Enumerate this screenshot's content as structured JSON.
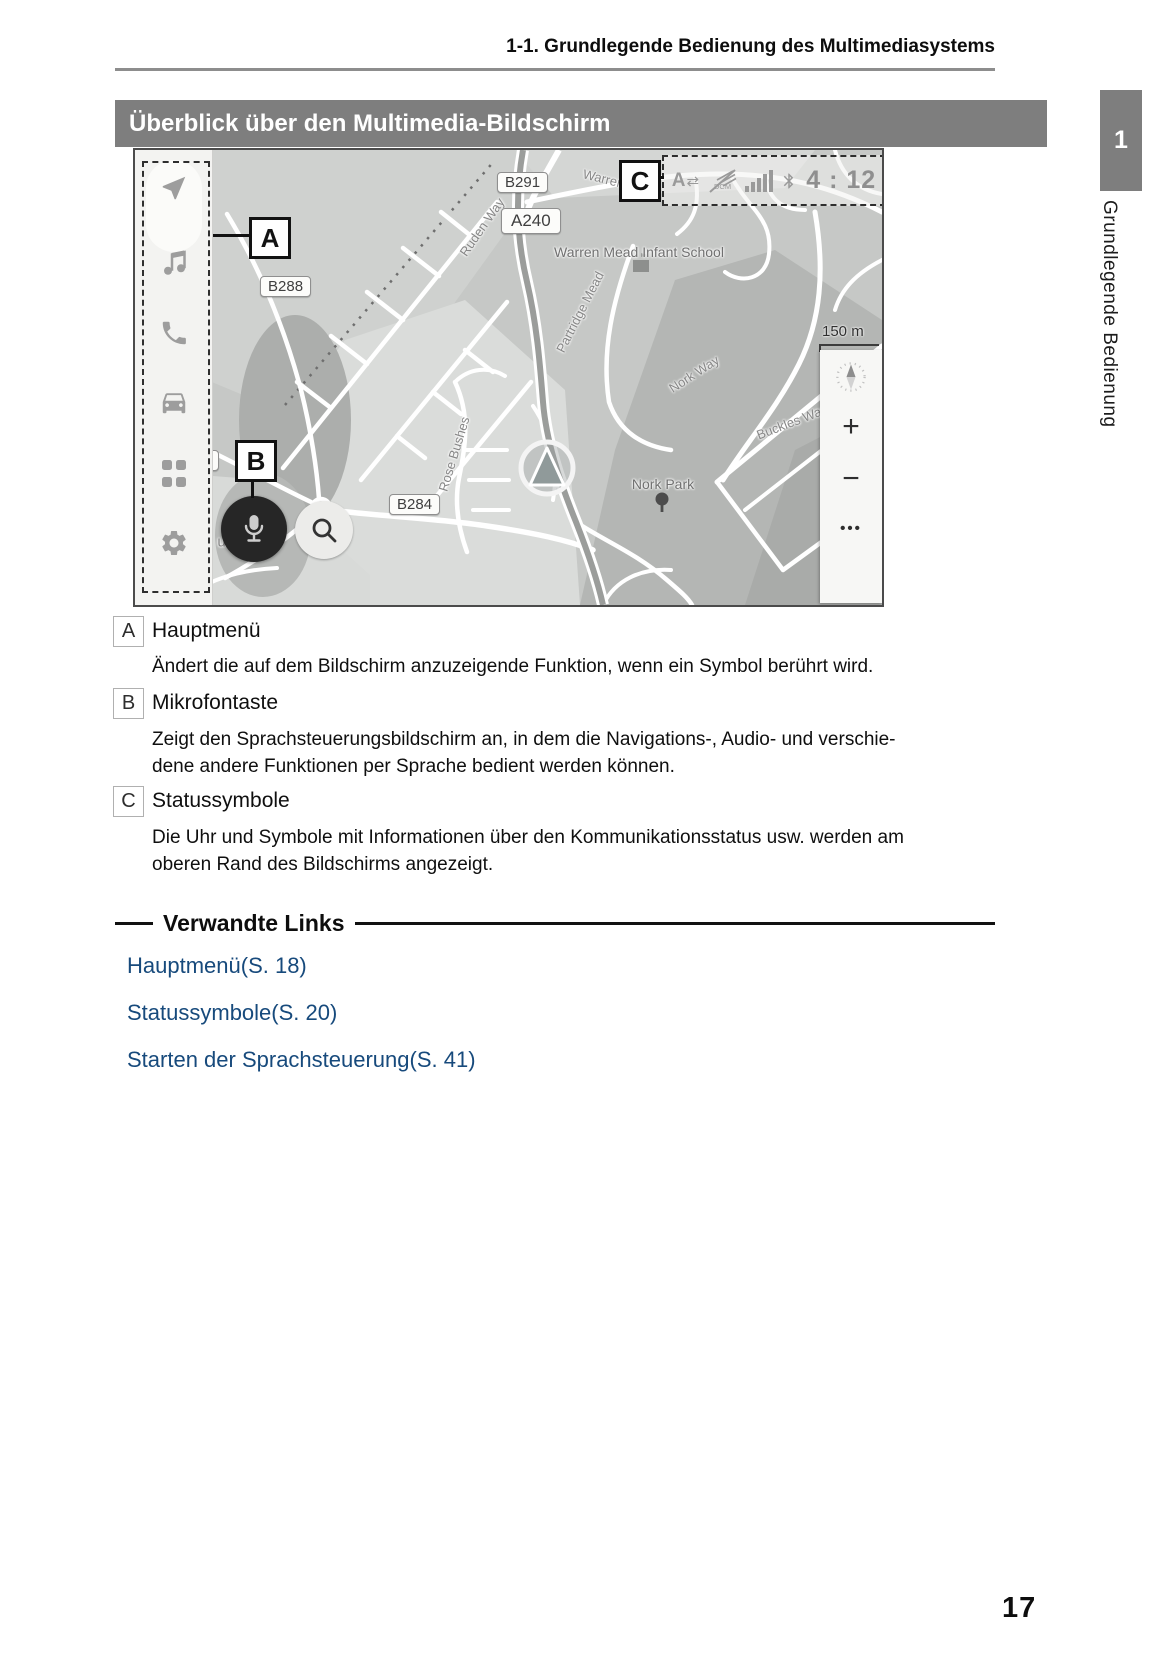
{
  "header": {
    "breadcrumb": "1-1. Grundlegende Bedienung des Multimediasystems"
  },
  "title_bar": {
    "title": "Überblick über den Multimedia-Bildschirm"
  },
  "side": {
    "chapter_tab": "1",
    "chapter_label": "Grundlegende Bedienung"
  },
  "colors": {
    "link": "#174a7c",
    "title_bar_bg": "#7e7e7e",
    "map_base": "#c6c8c6"
  },
  "screenshot": {
    "callouts": {
      "a": "A",
      "b": "B",
      "c": "C"
    },
    "status_bar": {
      "a_label": "A",
      "arrows": "⇄",
      "dcm_label": "DCM",
      "clock": "4 : 12"
    },
    "road_labels": {
      "b291": "B291",
      "a240": "A240",
      "b288": "B288",
      "b284": "B284",
      "partial_4": "4"
    },
    "streets": {
      "ruden_way": "Ruden Way",
      "warren_road": "Warren Roa",
      "school": "Warren Mead Infant School",
      "partridge_mead": "Partridge Mead",
      "nork_way": "Nork Way",
      "buckles_way": "Buckles Way",
      "rose_bushes": "Rose Bushes",
      "nork_park": "Nork Park",
      "course_partial": "urse",
      "hillside_partial": "Hillside"
    },
    "scale": "150 m",
    "controls": {
      "zoom_in": "+",
      "zoom_out": "−",
      "more": "•••"
    }
  },
  "legend": [
    {
      "key": "A",
      "title": "Hauptmenü",
      "lines": [
        "Ändert die auf dem Bildschirm anzuzeigende Funktion, wenn ein Symbol berührt wird."
      ]
    },
    {
      "key": "B",
      "title": "Mikrofontaste",
      "lines": [
        "Zeigt den Sprachsteuerungsbildschirm an, in dem die Navigations-, Audio- und verschie-",
        "dene andere Funktionen per Sprache bedient werden können."
      ]
    },
    {
      "key": "C",
      "title": "Statussymbole",
      "lines": [
        "Die Uhr und Symbole mit Informationen über den Kommunikationsstatus usw. werden am",
        "oberen Rand des Bildschirms angezeigt."
      ]
    }
  ],
  "related": {
    "title": "Verwandte Links",
    "links": [
      "Hauptmenü(S. 18)",
      "Statussymbole(S. 20)",
      "Starten der Sprachsteuerung(S. 41)"
    ]
  },
  "footer": {
    "page_number": "17"
  }
}
